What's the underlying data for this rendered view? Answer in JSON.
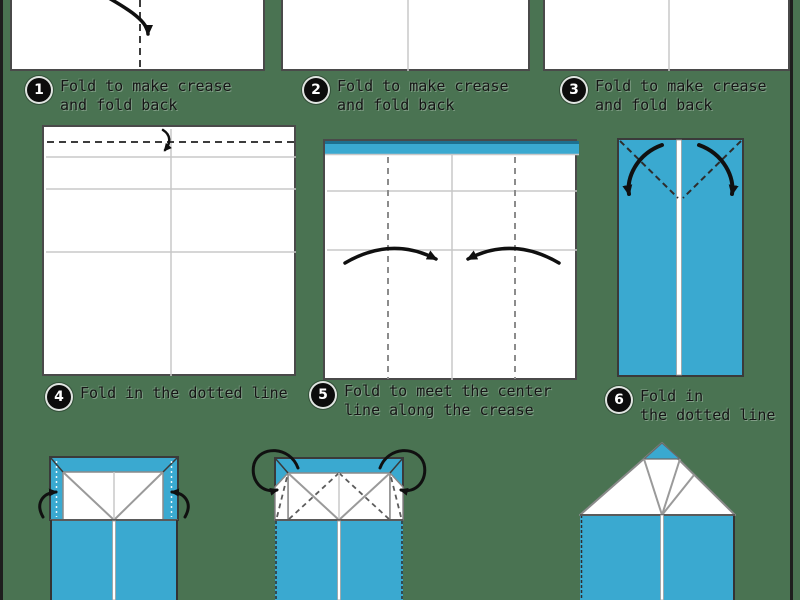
{
  "page": {
    "background": "#4A7352",
    "frame_color": "#1e1e1e"
  },
  "colors": {
    "page_bg": "#4A7352",
    "frame": "#1e1e1e",
    "paper_blue": "#3AA9D0",
    "paper_blue_dark": "#1d708f",
    "paper_white": "#ffffff",
    "outline_gray": "#4a4a4a",
    "crease_gray": "#c8c8c8",
    "arrow": "#101010"
  },
  "steps": [
    {
      "number": "1",
      "line1": "Fold to make crease",
      "line2": "and fold back"
    },
    {
      "number": "2",
      "line1": "Fold to make crease",
      "line2": "and fold back"
    },
    {
      "number": "3",
      "line1": "Fold to make crease",
      "line2": "and fold back"
    },
    {
      "number": "4",
      "line1": "Fold in the dotted line",
      "line2": ""
    },
    {
      "number": "5",
      "line1": "Fold to meet the center",
      "line2": "line along the crease"
    },
    {
      "number": "6",
      "line1": "Fold in",
      "line2": "the dotted line"
    }
  ]
}
